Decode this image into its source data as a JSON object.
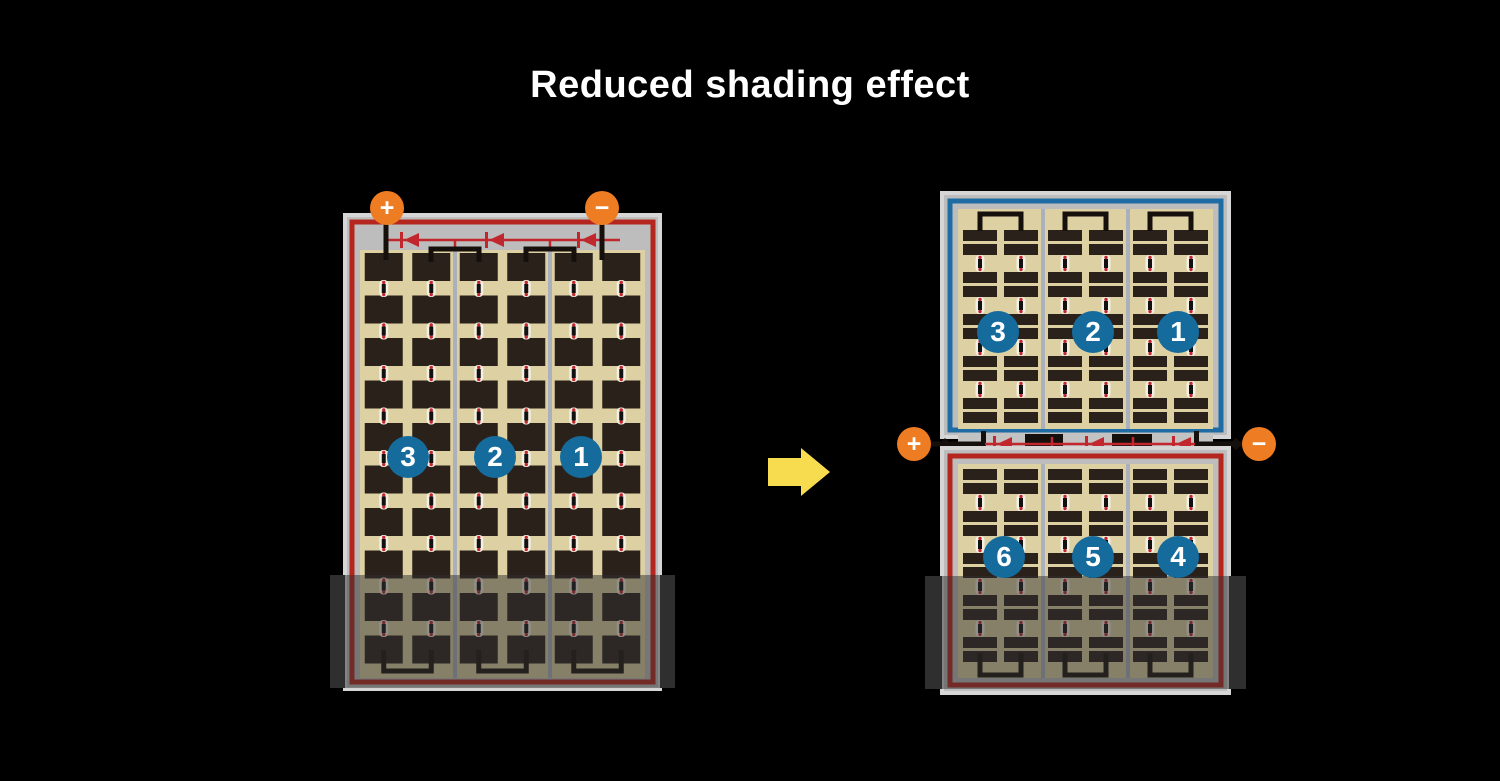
{
  "title": "Reduced shading effect",
  "colors": {
    "background": "#000000",
    "title_text": "#ffffff",
    "frame": "#bdbdbd",
    "frame_rim": "#d6d6d6",
    "cell": "#2a211a",
    "cell_bg": "#ddd0a2",
    "red_border": "#b4261e",
    "diode": "#c1272d",
    "blue_border": "#1e6ca3",
    "badge": "#166b9d",
    "badge_text": "#ffffff",
    "terminal": "#ee7c23",
    "terminal_text": "#ffffff",
    "separator": "#aab1bd",
    "wire": "#16100c",
    "connector_white": "#f4efe3",
    "connector_bar": "#111111",
    "junction_gray": "#c3c3c3",
    "shade": "rgba(47,47,47,0.5)",
    "shade_edge": "#2f2f2f",
    "arrow": "#f8dc50"
  },
  "left_panel": {
    "strings": [
      "3",
      "2",
      "1"
    ],
    "terminals": {
      "positive": "+",
      "negative": "−"
    },
    "diode_count": 3,
    "cell_columns": 6,
    "cell_rows": 10
  },
  "right_panel": {
    "top_strings": [
      "3",
      "2",
      "1"
    ],
    "bottom_strings": [
      "6",
      "5",
      "4"
    ],
    "terminals": {
      "positive": "+",
      "negative": "−"
    },
    "diode_count": 3,
    "cell_groups": 3
  }
}
